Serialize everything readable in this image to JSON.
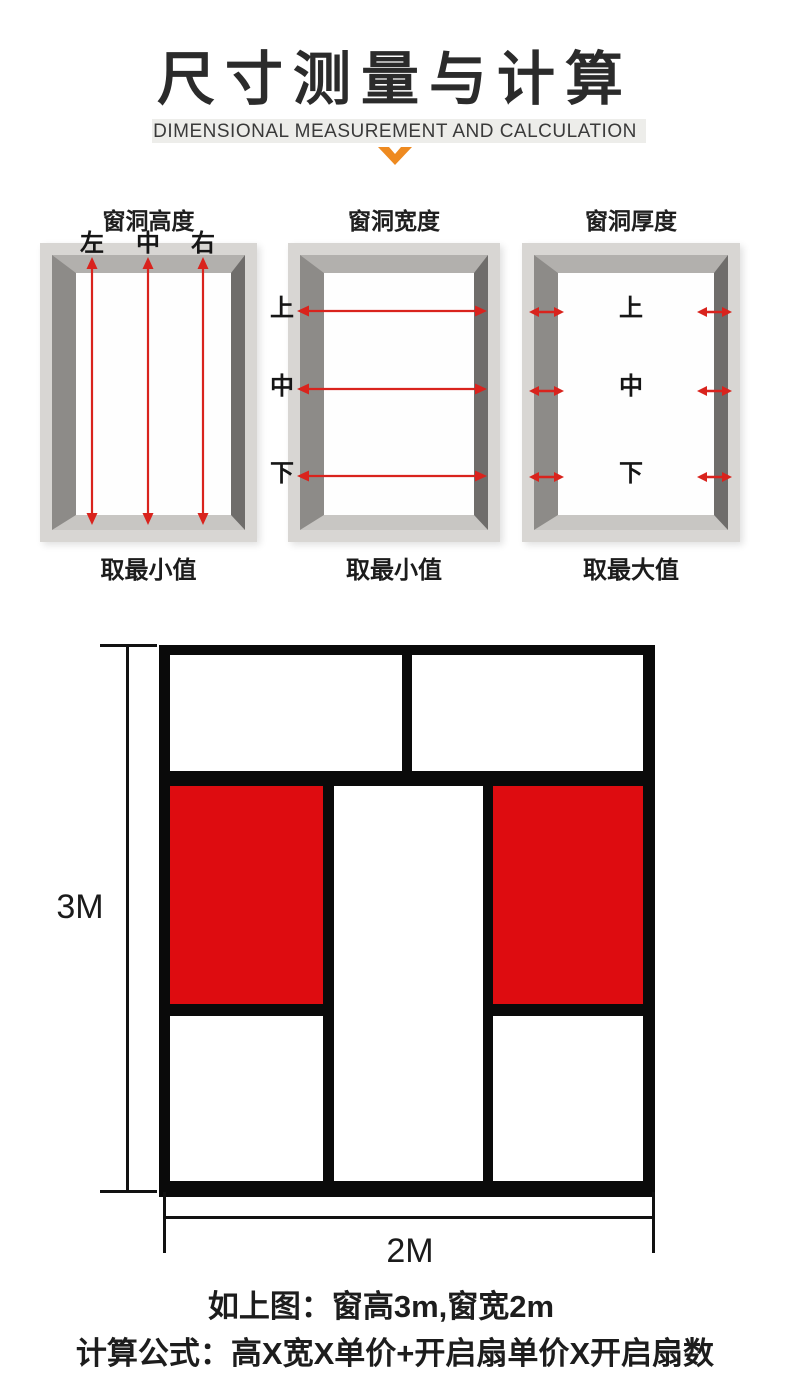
{
  "header": {
    "title": "尺寸测量与计算",
    "subtitle": "DIMENSIONAL MEASUREMENT AND CALCULATION"
  },
  "diagrams": [
    {
      "title": "窗洞高度",
      "labels": [
        "左",
        "中",
        "右"
      ],
      "caption": "取最小值",
      "measurement": "vertical-height"
    },
    {
      "title": "窗洞宽度",
      "labels": [
        "上",
        "中",
        "下"
      ],
      "caption": "取最小值",
      "measurement": "horizontal-width"
    },
    {
      "title": "窗洞厚度",
      "labels": [
        "上",
        "中",
        "下"
      ],
      "caption": "取最大值",
      "measurement": "wall-thickness"
    }
  ],
  "window_diagram": {
    "height_label": "3M",
    "width_label": "2M"
  },
  "footer": {
    "line1": "如上图：窗高3m,窗宽2m",
    "line2": "计算公式：高X宽X单价+开启扇单价X开启扇数"
  },
  "colors": {
    "sash_red": "#de0c10",
    "arrow_red": "#d9231d",
    "accent_orange": "#ee8a20",
    "frame_black": "#0a0a0a",
    "frame_gray_outer": "#d8d6d3"
  }
}
